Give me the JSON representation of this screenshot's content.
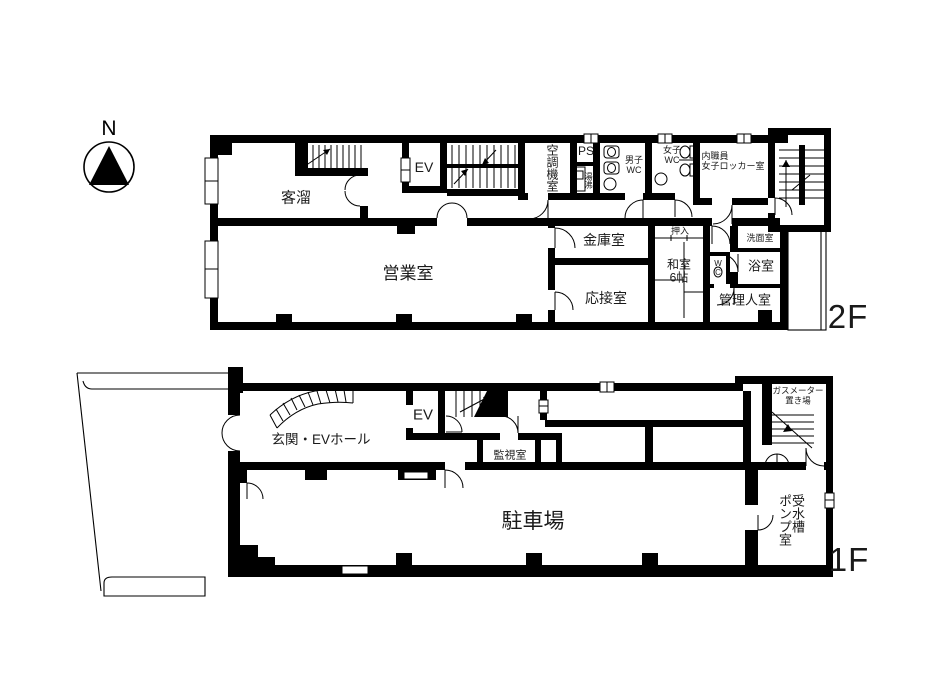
{
  "colors": {
    "ink": "#000000",
    "paper": "#ffffff"
  },
  "compass": {
    "north_label": "N"
  },
  "floor2": {
    "floor_label": "2F",
    "rooms": {
      "kyakudamari": "客溜",
      "ev": "EV",
      "kucho_kishitsu": "空調機室",
      "ps": "PS",
      "yuwakashi": "湯沸",
      "danshi_wc": {
        "line1": "男子",
        "line2": "WC"
      },
      "joshi_wc": {
        "line1": "女子",
        "line2": "WC"
      },
      "locker_room": {
        "line1": "内職員",
        "line2": "女子ロッカー室"
      },
      "kinko_shitsu": "金庫室",
      "eigyo_shitsu": "営業室",
      "osetsu_shitsu": "応接室",
      "oshiire": "押入",
      "washitsu": {
        "line1": "和室",
        "line2": "6帖"
      },
      "wc": {
        "line1": "W",
        "line2": "C"
      },
      "senmen_shitsu": "洗面室",
      "yokushitsu": "浴室",
      "kanrinin_shitsu": "管理人室"
    }
  },
  "floor1": {
    "floor_label": "1F",
    "rooms": {
      "genkan_ev_hall": "玄関・EVホール",
      "ev": "EV",
      "kanshi_shitsu": "監視室",
      "chushajo": "駐車場",
      "gas_meter": {
        "line1": "ガスメーター",
        "line2": "置き場"
      },
      "jusuiso": {
        "col1": "受水槽",
        "col2": "ポンプ室"
      }
    }
  }
}
